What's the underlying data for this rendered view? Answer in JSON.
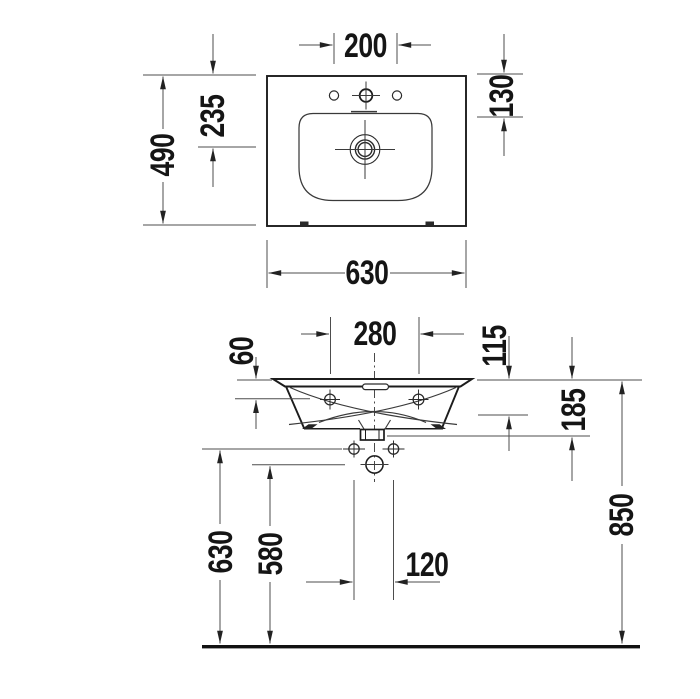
{
  "drawing": {
    "kind": "washbasin installation technical drawing",
    "line_color": "#1c1c1c",
    "dim_line_color": "#4d4d4d",
    "background": "#ffffff"
  },
  "labels": {
    "top": {
      "tap_spacing": "200",
      "offset_130": "130",
      "offset_235": "235",
      "depth_490": "490",
      "width_630": "630"
    },
    "front": {
      "anchor_spacing": "280",
      "offset_60": "60",
      "offset_115": "115",
      "offset_185": "185",
      "height_630": "630",
      "height_580": "580",
      "outlet_spacing": "120",
      "rim_height_850": "850"
    }
  }
}
